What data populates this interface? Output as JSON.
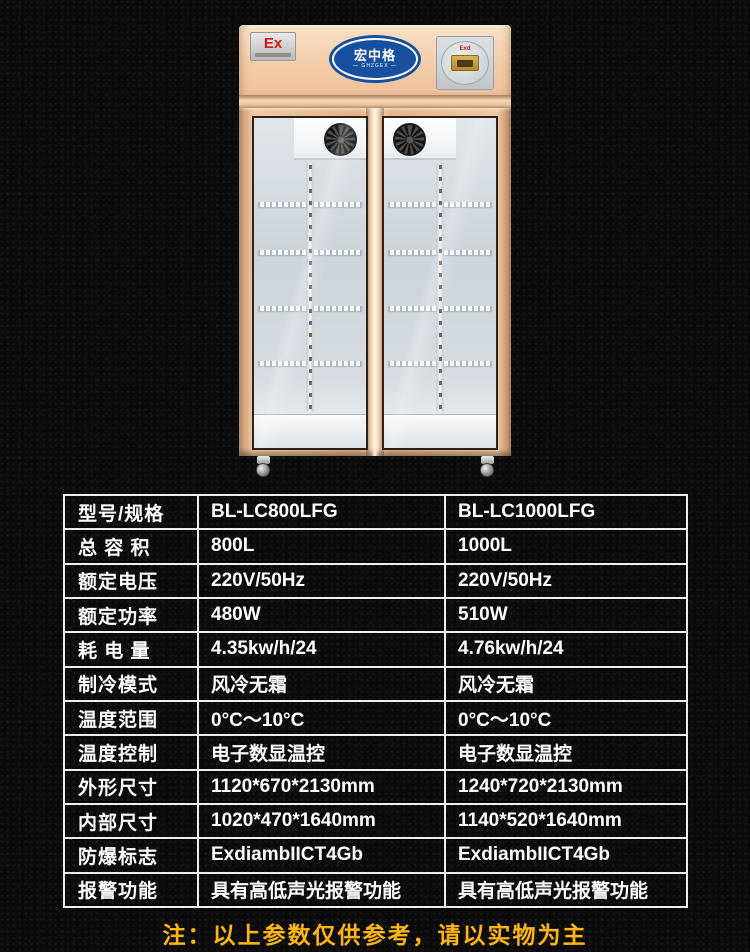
{
  "fridge": {
    "ex_badge_label": "Ex",
    "brand_name": "宏中格",
    "brand_subtitle": "— GHZGEX —",
    "controller_label": "Exd"
  },
  "spec_table": {
    "rows": [
      {
        "label": "型号/规格",
        "col1": "BL-LC800LFG",
        "col2": "BL-LC1000LFG"
      },
      {
        "label": "总 容 积",
        "col1": "800L",
        "col2": "1000L"
      },
      {
        "label": "额定电压",
        "col1": "220V/50Hz",
        "col2": "220V/50Hz"
      },
      {
        "label": "额定功率",
        "col1": "480W",
        "col2": "510W"
      },
      {
        "label": "耗 电 量",
        "col1": "4.35kw/h/24",
        "col2": "4.76kw/h/24"
      },
      {
        "label": "制冷模式",
        "col1": "风冷无霜",
        "col2": "风冷无霜"
      },
      {
        "label": "温度范围",
        "col1": "0°C～10°C",
        "col2": "0°C～10°C"
      },
      {
        "label": "温度控制",
        "col1": "电子数显温控",
        "col2": "电子数显温控"
      },
      {
        "label": "外形尺寸",
        "col1": "1120*670*2130mm",
        "col2": "1240*720*2130mm"
      },
      {
        "label": "内部尺寸",
        "col1": "1020*470*1640mm",
        "col2": "1140*520*1640mm"
      },
      {
        "label": "防爆标志",
        "col1": "ExdiambIICT4Gb",
        "col2": "ExdiambIICT4Gb"
      },
      {
        "label": "报警功能",
        "col1": "具有高低声光报警功能",
        "col2": "具有高低声光报警功能"
      }
    ]
  },
  "note": "注：以上参数仅供参考，请以实物为主",
  "colors": {
    "background": "#0b0b0b",
    "panel_champagne": "#f3cda8",
    "frame_rose_gold": "#e2b48c",
    "logo_blue": "#17509e",
    "ex_red": "#ce1f13",
    "table_border": "#ededed",
    "note_yellow": "#feb510"
  }
}
